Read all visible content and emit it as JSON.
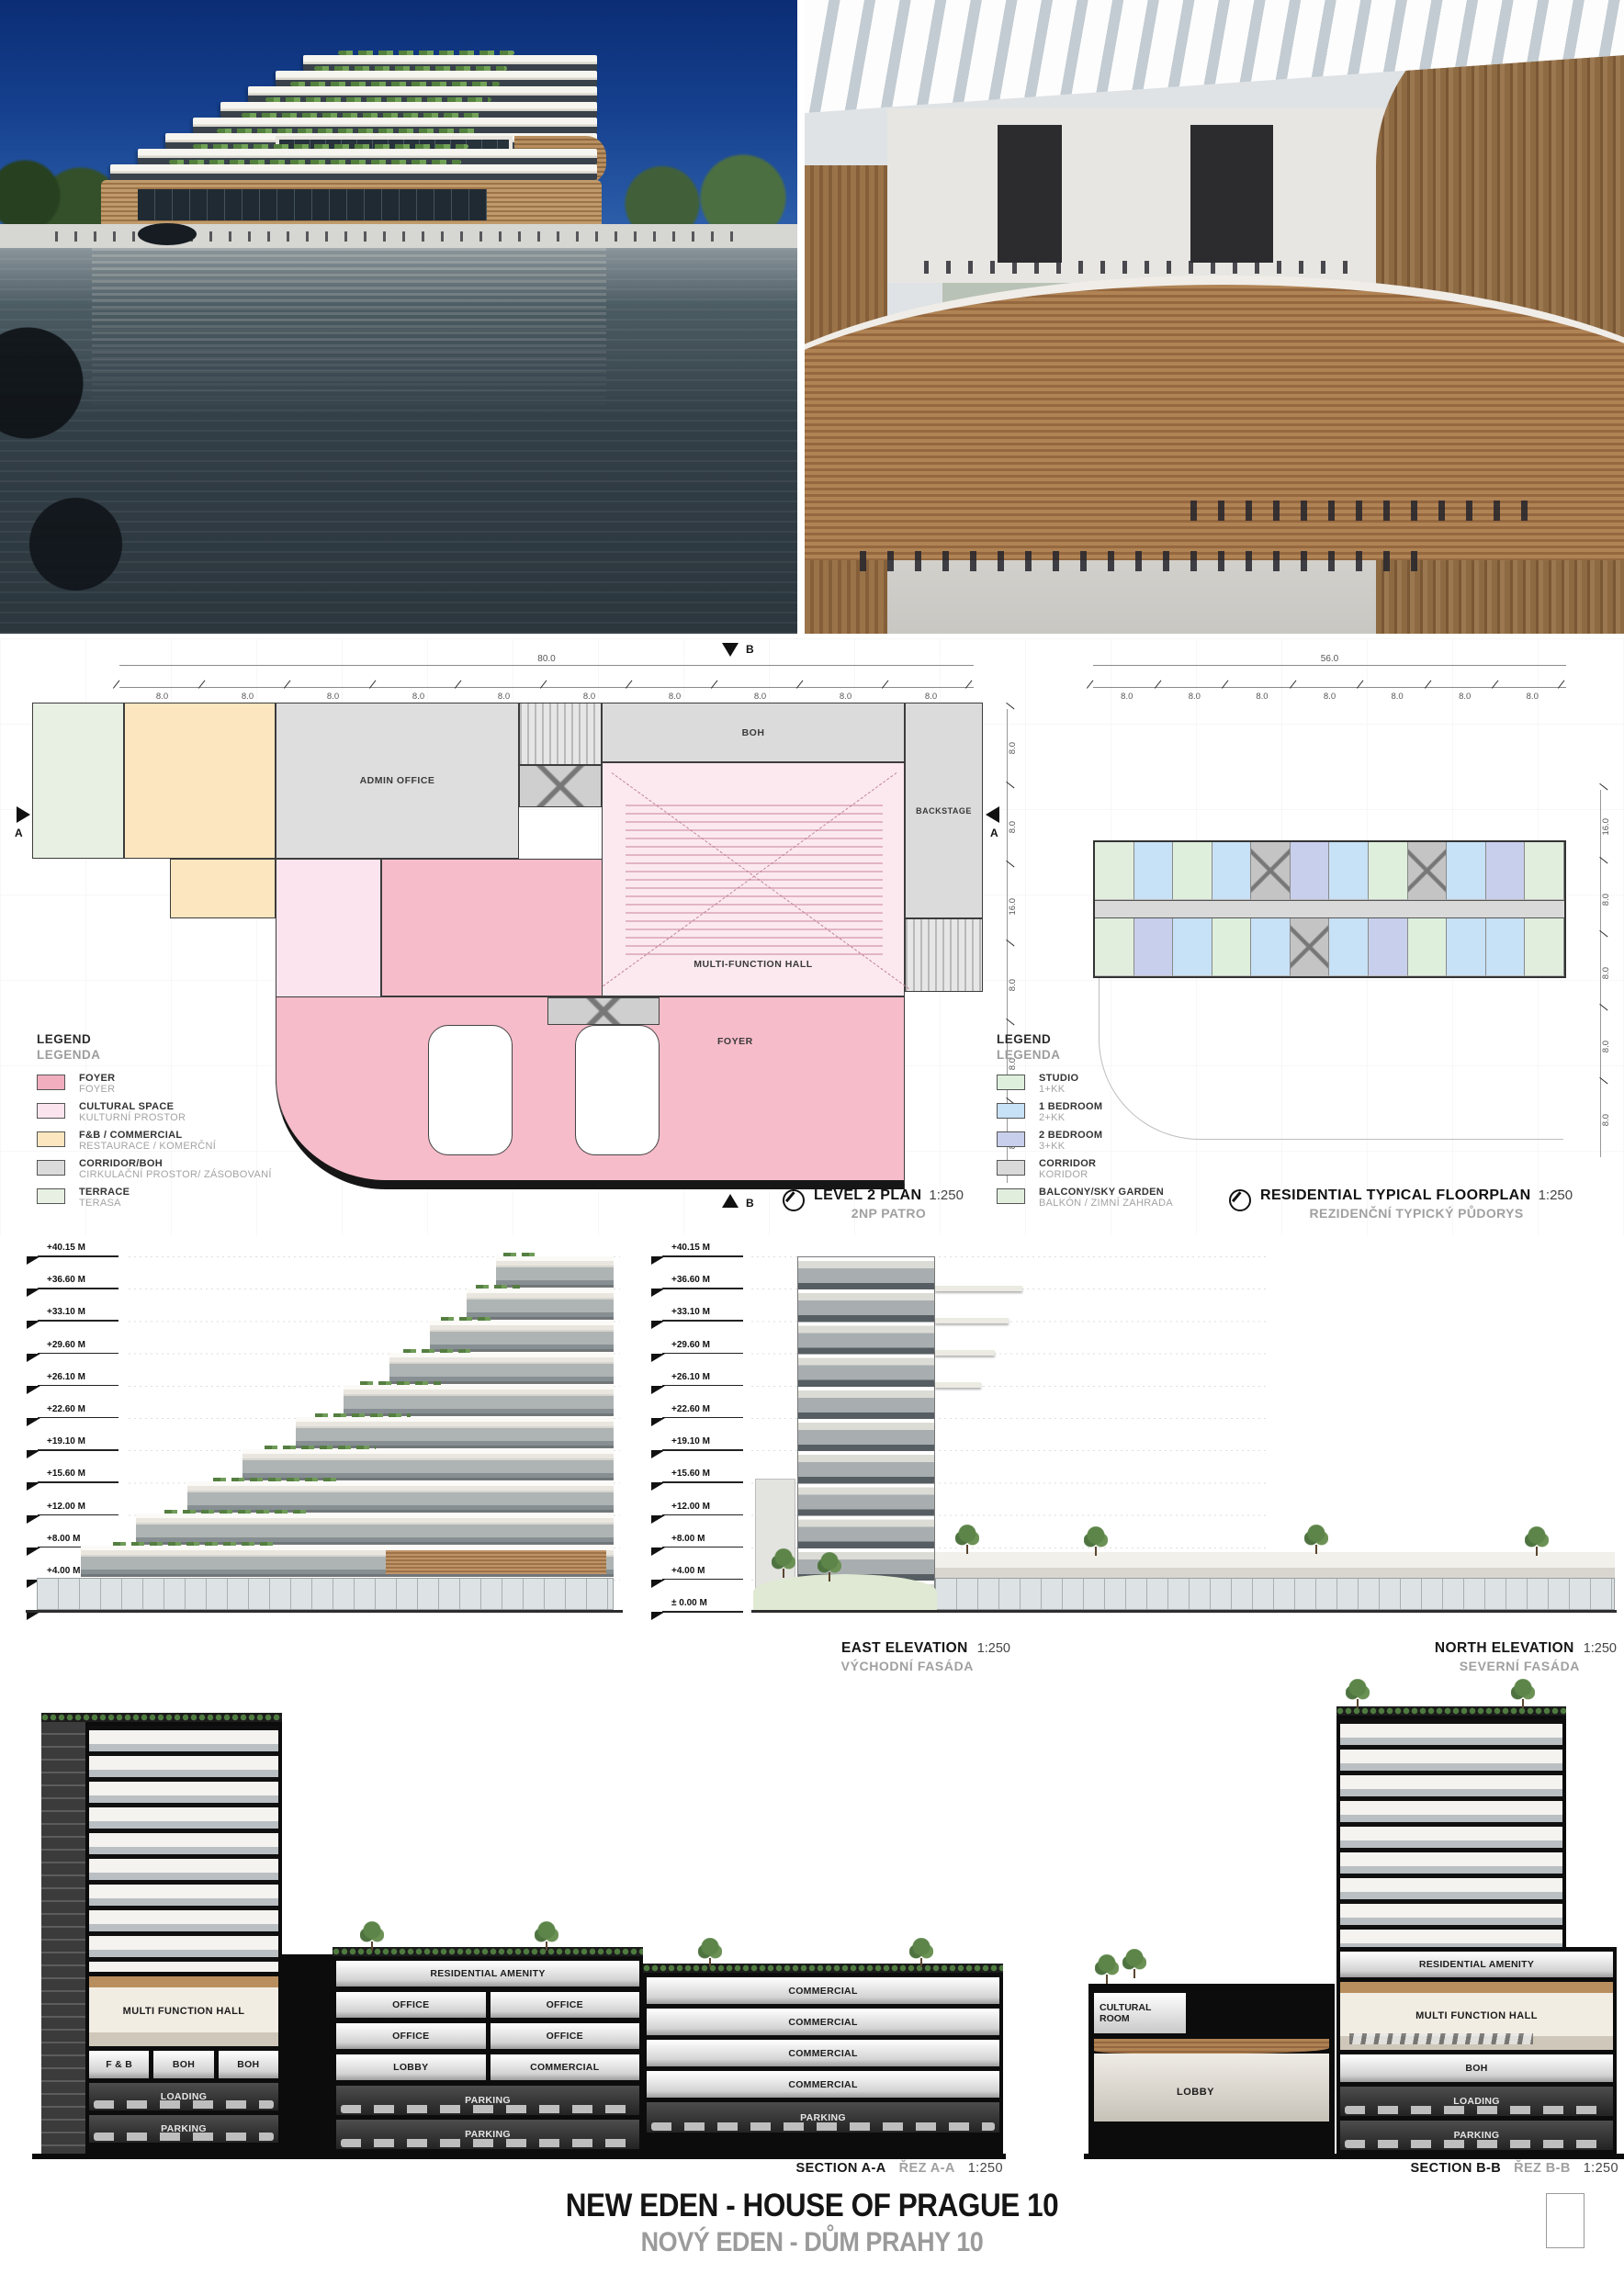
{
  "title": {
    "en": "NEW EDEN - HOUSE OF PRAGUE 10",
    "cz": "NOVÝ EDEN - DŮM PRAHY 10"
  },
  "levels": [
    "+40.15 M",
    "+36.60 M",
    "+33.10 M",
    "+29.60 M",
    "+26.10 M",
    "+22.60 M",
    "+19.10 M",
    "+15.60 M",
    "+12.00 M",
    "+8.00 M",
    "+4.00 M",
    "± 0.00 M"
  ],
  "plan_level2": {
    "title": "LEVEL 2 PLAN",
    "scale": "1:250",
    "subtitle": "2NP PATRO",
    "dim_total": "80.0",
    "dims_top": [
      "8.0",
      "8.0",
      "8.0",
      "8.0",
      "8.0",
      "8.0",
      "8.0",
      "8.0",
      "8.0",
      "8.0"
    ],
    "dims_side": [
      "8.0",
      "8.0",
      "16.0",
      "8.0",
      "8.0",
      "8.0"
    ],
    "marker_a": "A",
    "marker_b": "B",
    "rooms": {
      "admin": "ADMIN OFFICE",
      "boh": "BOH",
      "backstage": "BACKSTAGE",
      "hall": "MULTI-FUNCTION HALL",
      "foyer": "FOYER"
    },
    "legend": {
      "title_en": "LEGEND",
      "title_cz": "LEGENDA",
      "items": [
        {
          "en": "FOYER",
          "cz": "FOYER",
          "color": "#f1aebf"
        },
        {
          "en": "CULTURAL SPACE",
          "cz": "KULTURNÍ PROSTOR",
          "color": "#fbe4ed"
        },
        {
          "en": "F&B / COMMERCIAL",
          "cz": "RESTAURACE / KOMERČNÍ",
          "color": "#fbe6bf"
        },
        {
          "en": "CORRIDOR/BOH",
          "cz": "CIRKULAČNÍ PROSTOR/ ZÁSOBOVANÍ",
          "color": "#dbdbdb"
        },
        {
          "en": "TERRACE",
          "cz": "TERASA",
          "color": "#e7f0e3"
        }
      ]
    }
  },
  "plan_res": {
    "title": "RESIDENTIAL TYPICAL FLOORPLAN",
    "scale": "1:250",
    "subtitle": "REZIDENČNÍ TYPICKÝ PŮDORYS",
    "dim_total": "56.0",
    "dims_top": [
      "8.0",
      "8.0",
      "8.0",
      "8.0",
      "8.0",
      "8.0",
      "8.0"
    ],
    "dims_side": [
      "16.0",
      "8.0",
      "8.0",
      "8.0",
      "8.0"
    ],
    "units_top": [
      "g",
      "1br",
      "st",
      "1br",
      "core",
      "2br",
      "1br",
      "st",
      "core",
      "1br",
      "2br",
      "g"
    ],
    "units_bottom": [
      "g",
      "2br",
      "1br",
      "st",
      "1br",
      "core",
      "1br",
      "2br",
      "st",
      "1br",
      "1br",
      "g"
    ],
    "legend": {
      "title_en": "LEGEND",
      "title_cz": "LEGENDA",
      "items": [
        {
          "en": "STUDIO",
          "cz": "1+KK",
          "color": "#def0dc"
        },
        {
          "en": "1 BEDROOM",
          "cz": "2+KK",
          "color": "#c7e1f6"
        },
        {
          "en": "2 BEDROOM",
          "cz": "3+KK",
          "color": "#c8cfec"
        },
        {
          "en": "CORRIDOR",
          "cz": "KORIDOR",
          "color": "#d9d9d9"
        },
        {
          "en": "BALCONY/SKY GARDEN",
          "cz": "BALKÓN / ZIMNÍ ZAHRADA",
          "color": "#e1eedd"
        }
      ]
    }
  },
  "elev_east": {
    "title": "EAST ELEVATION",
    "scale": "1:250",
    "subtitle": "VÝCHODNÍ FASÁDA"
  },
  "elev_north": {
    "title": "NORTH ELEVATION",
    "scale": "1:250",
    "subtitle": "SEVERNÍ FASÁDA"
  },
  "section_a": {
    "title": "SECTION A-A",
    "title_cz": "ŘEZ A-A",
    "scale": "1:250",
    "hall": "MULTI FUNCTION HALL",
    "tower_rows": [
      [
        "F & B",
        "BOH",
        "BOH"
      ],
      [
        "LOADING"
      ],
      [
        "PARKING"
      ]
    ],
    "mid_rows": [
      [
        "RESIDENTIAL AMENITY"
      ],
      [
        "OFFICE",
        "OFFICE"
      ],
      [
        "OFFICE",
        "OFFICE"
      ],
      [
        "LOBBY",
        "COMMERCIAL"
      ],
      [
        "PARKING"
      ],
      [
        "PARKING"
      ]
    ],
    "right_rows": [
      [
        "COMMERCIAL"
      ],
      [
        "COMMERCIAL"
      ],
      [
        "COMMERCIAL"
      ],
      [
        "COMMERCIAL"
      ],
      [
        "PARKING"
      ]
    ]
  },
  "section_b": {
    "title": "SECTION B-B",
    "title_cz": "ŘEZ B-B",
    "scale": "1:250",
    "cultural": "CULTURAL ROOM",
    "lobby": "LOBBY",
    "amenity": "RESIDENTIAL AMENITY",
    "hall": "MULTI FUNCTION HALL",
    "rows": [
      [
        "BOH"
      ],
      [
        "LOADING"
      ],
      [
        "PARKING"
      ]
    ]
  }
}
